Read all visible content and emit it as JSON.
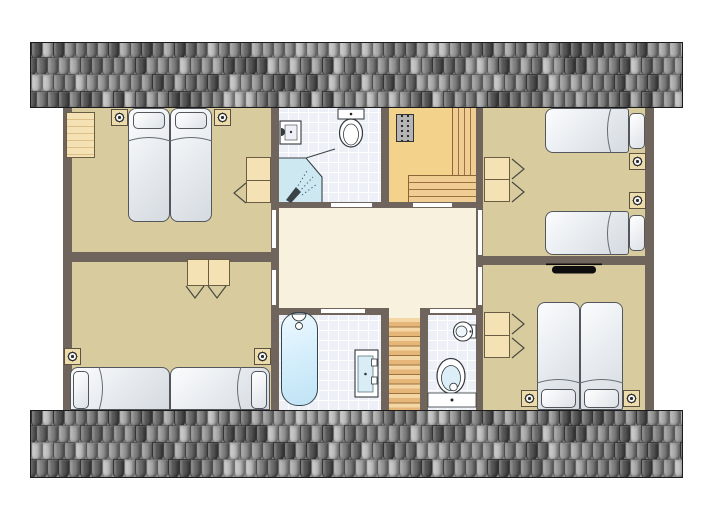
{
  "view": {
    "kind": "floor-plan",
    "description": "attic floor plan of holiday home, no text labels"
  },
  "palette": {
    "wall": "#6f655c",
    "bedroom": "#d8cc9e",
    "hall": "#f8f1dd",
    "landing": "#f3d38c",
    "bath": "#edf1f7",
    "tileline": "rgba(255,255,255,0.95)",
    "shower": "#cde8f1",
    "wood": "#f4e2b5",
    "stairline": "#9c7340",
    "door": "#ffffff",
    "lightbox": "#ecdcab",
    "metal": "#b5b5b5",
    "roofborder": "#1b1b1b",
    "tv": "#0d0d0d",
    "fixture_outline": "#33383c",
    "roof_tiles": [
      "#585858",
      "#6e6e6e",
      "#838383",
      "#989898",
      "#ababab",
      "#c0c0c0"
    ]
  },
  "roof": {
    "tile_width": 11,
    "row_offsets": [
      -3,
      14,
      31,
      48
    ],
    "strips": [
      "roof-top",
      "roof-bottom"
    ]
  },
  "rooms": [
    {
      "name": "bedroom-top-left",
      "floor": "bedroom",
      "items": [
        "wardrobe",
        "double-bed",
        "two-pillows",
        "wall-light-left",
        "wall-light-right",
        "desk",
        "chair"
      ]
    },
    {
      "name": "bathroom-top",
      "floor": "bath",
      "items": [
        "washbasin",
        "toilet",
        "corner-shower"
      ]
    },
    {
      "name": "stair-landing",
      "floor": "landing",
      "items": [
        "meter-cabinet",
        "l-shaped-staircase"
      ]
    },
    {
      "name": "bedroom-top-right",
      "floor": "bedroom",
      "items": [
        "single-bed-upper",
        "single-bed-lower",
        "desk",
        "two-chairs",
        "wall-light-upper",
        "wall-light-lower"
      ]
    },
    {
      "name": "hallway",
      "floor": "hall",
      "items": []
    },
    {
      "name": "bedroom-bottom-left",
      "floor": "bedroom",
      "items": [
        "desk",
        "two-chairs",
        "single-bed-left",
        "single-bed-right",
        "wall-light-left",
        "wall-light-right"
      ]
    },
    {
      "name": "bathroom-bottom",
      "floor": "bath",
      "items": [
        "bathtub",
        "vanity-washbasin"
      ]
    },
    {
      "name": "staircase-down",
      "floor": "hall",
      "items": [
        "wooden-treads"
      ]
    },
    {
      "name": "wc",
      "floor": "bath",
      "items": [
        "small-washbasin",
        "toilet",
        "cistern"
      ]
    },
    {
      "name": "bedroom-bottom-right",
      "floor": "bedroom",
      "items": [
        "tv-unit",
        "desk",
        "two-chairs",
        "double-bed",
        "two-pillows",
        "wall-light-left",
        "wall-light-right"
      ]
    }
  ],
  "doors": [
    {
      "name": "door-bedroom-top-left",
      "wall": "hall-left"
    },
    {
      "name": "door-bedroom-bottom-left",
      "wall": "hall-left"
    },
    {
      "name": "door-bedroom-top-right",
      "wall": "hall-right"
    },
    {
      "name": "door-bedroom-bottom-right",
      "wall": "hall-right"
    },
    {
      "name": "door-bathroom-top",
      "wall": "hall-top"
    },
    {
      "name": "door-stair-landing",
      "wall": "hall-top"
    },
    {
      "name": "door-bathroom-bottom",
      "wall": "hall-bottom"
    },
    {
      "name": "door-wc",
      "wall": "hall-bottom"
    }
  ]
}
